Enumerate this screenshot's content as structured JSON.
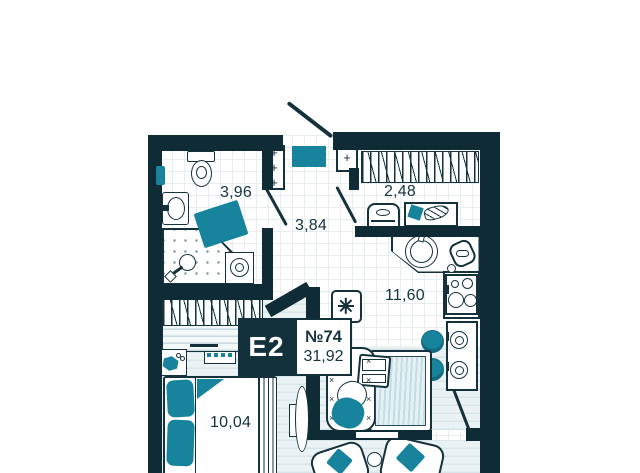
{
  "plan": {
    "unit_badge": {
      "type": "E2",
      "number": "№74",
      "area_total": "31,92"
    },
    "rooms": [
      {
        "name": "bathroom",
        "area": "3,96"
      },
      {
        "name": "hallway",
        "area": "3,84"
      },
      {
        "name": "wardrobe",
        "area": "2,48"
      },
      {
        "name": "kitchen-living",
        "area": "11,60"
      },
      {
        "name": "bedroom",
        "area": "10,04"
      }
    ]
  },
  "symbols": {
    "plus": "+",
    "stitch_col": "×\n×\n×\n×"
  },
  "palette": {
    "wall": "#0f2c36",
    "accent_teal": "#17839c",
    "floor_tile": "#ffffff",
    "floor_wood": "#eaf2f4",
    "texture_light": "#c2dde6",
    "text": "#14333e"
  },
  "icons": {
    "snowflake": "ac-unit",
    "plus": "electric-point",
    "stitch": "upholstery-stitch"
  }
}
